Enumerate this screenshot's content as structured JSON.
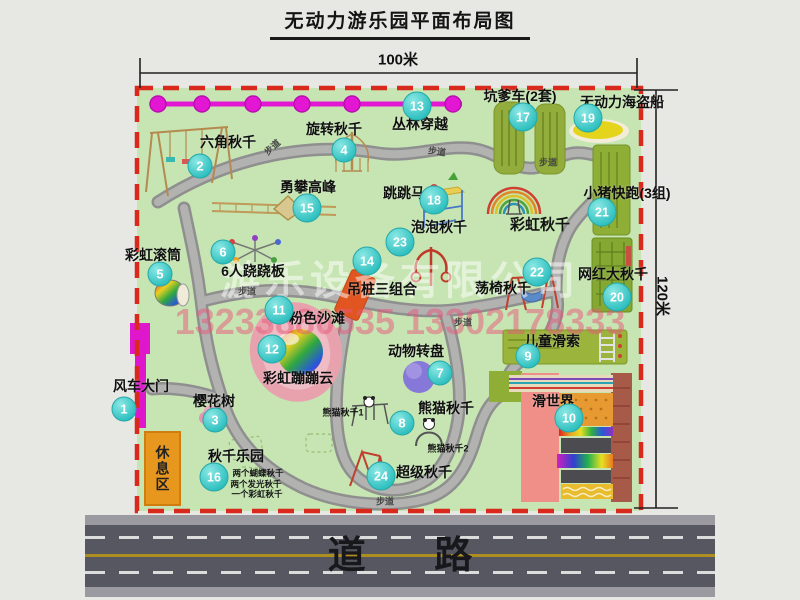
{
  "title": "无动力游乐园平面布局图",
  "dimensions": {
    "width_label": "100米",
    "height_label": "120米"
  },
  "road": {
    "label": "道 路"
  },
  "rest_area": {
    "label": "休息区"
  },
  "watermark": {
    "company": "游乐设备有限公司",
    "phone": "13233880535 13302178333"
  },
  "colors": {
    "park_green": "#c6e5b2",
    "border_red": "#d8291c",
    "path_gray": "#a0a0a0",
    "marker_teal": "#2ebfbf",
    "zipline_magenta": "#e316d4",
    "road_gray": "#575761",
    "rest_orange": "#e8971e"
  },
  "map": {
    "pois": [
      {
        "num": "1",
        "label": "风车大门",
        "mx": 124,
        "my": 409,
        "lx": 141,
        "ly": 386
      },
      {
        "num": "2",
        "label": "六角秋千",
        "mx": 200,
        "my": 166,
        "lx": 228,
        "ly": 142
      },
      {
        "num": "3",
        "label": "樱花树",
        "mx": 215,
        "my": 420,
        "lx": 214,
        "ly": 401
      },
      {
        "num": "4",
        "label": "旋转秋千",
        "mx": 344,
        "my": 150,
        "lx": 334,
        "ly": 129
      },
      {
        "num": "5",
        "label": "彩虹滚筒",
        "mx": 160,
        "my": 274,
        "lx": 153,
        "ly": 255
      },
      {
        "num": "6",
        "label": "6人跷跷板",
        "mx": 223,
        "my": 252,
        "lx": 253,
        "ly": 271
      },
      {
        "num": "7",
        "label": "动物转盘",
        "mx": 440,
        "my": 373,
        "lx": 416,
        "ly": 351
      },
      {
        "num": "8",
        "label": "熊猫秋千",
        "mx": 402,
        "my": 423,
        "lx": 446,
        "ly": 408
      },
      {
        "num": "9",
        "label": "儿童滑索",
        "mx": 528,
        "my": 356,
        "lx": 552,
        "ly": 341
      },
      {
        "num": "10",
        "label": "滑世界",
        "mx": 569,
        "my": 418,
        "lx": 553,
        "ly": 401
      },
      {
        "num": "11",
        "label": "粉色沙滩",
        "mx": 279,
        "my": 310,
        "lx": 317,
        "ly": 318
      },
      {
        "num": "12",
        "label": "彩虹蹦蹦云",
        "mx": 272,
        "my": 349,
        "lx": 298,
        "ly": 378
      },
      {
        "num": "13",
        "label": "丛林穿越",
        "mx": 417,
        "my": 106,
        "lx": 420,
        "ly": 124
      },
      {
        "num": "14",
        "label": "吊桩三组合",
        "mx": 367,
        "my": 261,
        "lx": 382,
        "ly": 289
      },
      {
        "num": "15",
        "label": "勇攀高峰",
        "mx": 307,
        "my": 208,
        "lx": 308,
        "ly": 187
      },
      {
        "num": "16",
        "label": "秋千乐园",
        "mx": 214,
        "my": 477,
        "lx": 236,
        "ly": 456
      },
      {
        "num": "17",
        "label": "坑爹车(2套)",
        "mx": 523,
        "my": 117,
        "lx": 520,
        "ly": 96
      },
      {
        "num": "18",
        "label": "跳跳马",
        "mx": 434,
        "my": 200,
        "lx": 404,
        "ly": 193
      },
      {
        "num": "19",
        "label": "无动力海盗船",
        "mx": 588,
        "my": 118,
        "lx": 622,
        "ly": 102
      },
      {
        "num": "20",
        "label": "网红大秋千",
        "mx": 617,
        "my": 297,
        "lx": 613,
        "ly": 274
      },
      {
        "num": "21",
        "label": "小猪快跑(3组)",
        "mx": 602,
        "my": 212,
        "lx": 627,
        "ly": 193
      },
      {
        "num": "22",
        "label": "荡椅秋千",
        "mx": 537,
        "my": 272,
        "lx": 503,
        "ly": 288
      },
      {
        "num": "23",
        "label": "泡泡秋千",
        "mx": 400,
        "my": 242,
        "lx": 439,
        "ly": 227
      },
      {
        "num": "24",
        "label": "超级秋千",
        "mx": 381,
        "my": 476,
        "lx": 424,
        "ly": 472
      }
    ],
    "sub_labels": [
      {
        "name": "rainbow-swing-label",
        "text": "彩虹秋千",
        "x": 540,
        "y": 224,
        "size": 15
      },
      {
        "name": "panda-swing-1-label",
        "text": "熊猫秋千1",
        "x": 343,
        "y": 412,
        "size": 9
      },
      {
        "name": "panda-swing-2-label",
        "text": "熊猫秋千2",
        "x": 448,
        "y": 448,
        "size": 9
      },
      {
        "name": "swing-park-note-1",
        "text": "两个蝴蝶秋千",
        "x": 258,
        "y": 473,
        "size": 8.5
      },
      {
        "name": "swing-park-note-2",
        "text": "两个发光秋千",
        "x": 256,
        "y": 484,
        "size": 8.5
      },
      {
        "name": "swing-park-note-3",
        "text": "一个彩虹秋千",
        "x": 257,
        "y": 494,
        "size": 8.5
      }
    ],
    "path_labels": [
      {
        "text": "步道",
        "x": 272,
        "y": 147,
        "rot": -42
      },
      {
        "text": "步道",
        "x": 437,
        "y": 151,
        "rot": 8
      },
      {
        "text": "步道",
        "x": 548,
        "y": 162,
        "rot": 0
      },
      {
        "text": "步道",
        "x": 247,
        "y": 291,
        "rot": 0
      },
      {
        "text": "步道",
        "x": 463,
        "y": 322,
        "rot": 0
      },
      {
        "text": "步道",
        "x": 385,
        "y": 501,
        "rot": 0
      }
    ]
  }
}
